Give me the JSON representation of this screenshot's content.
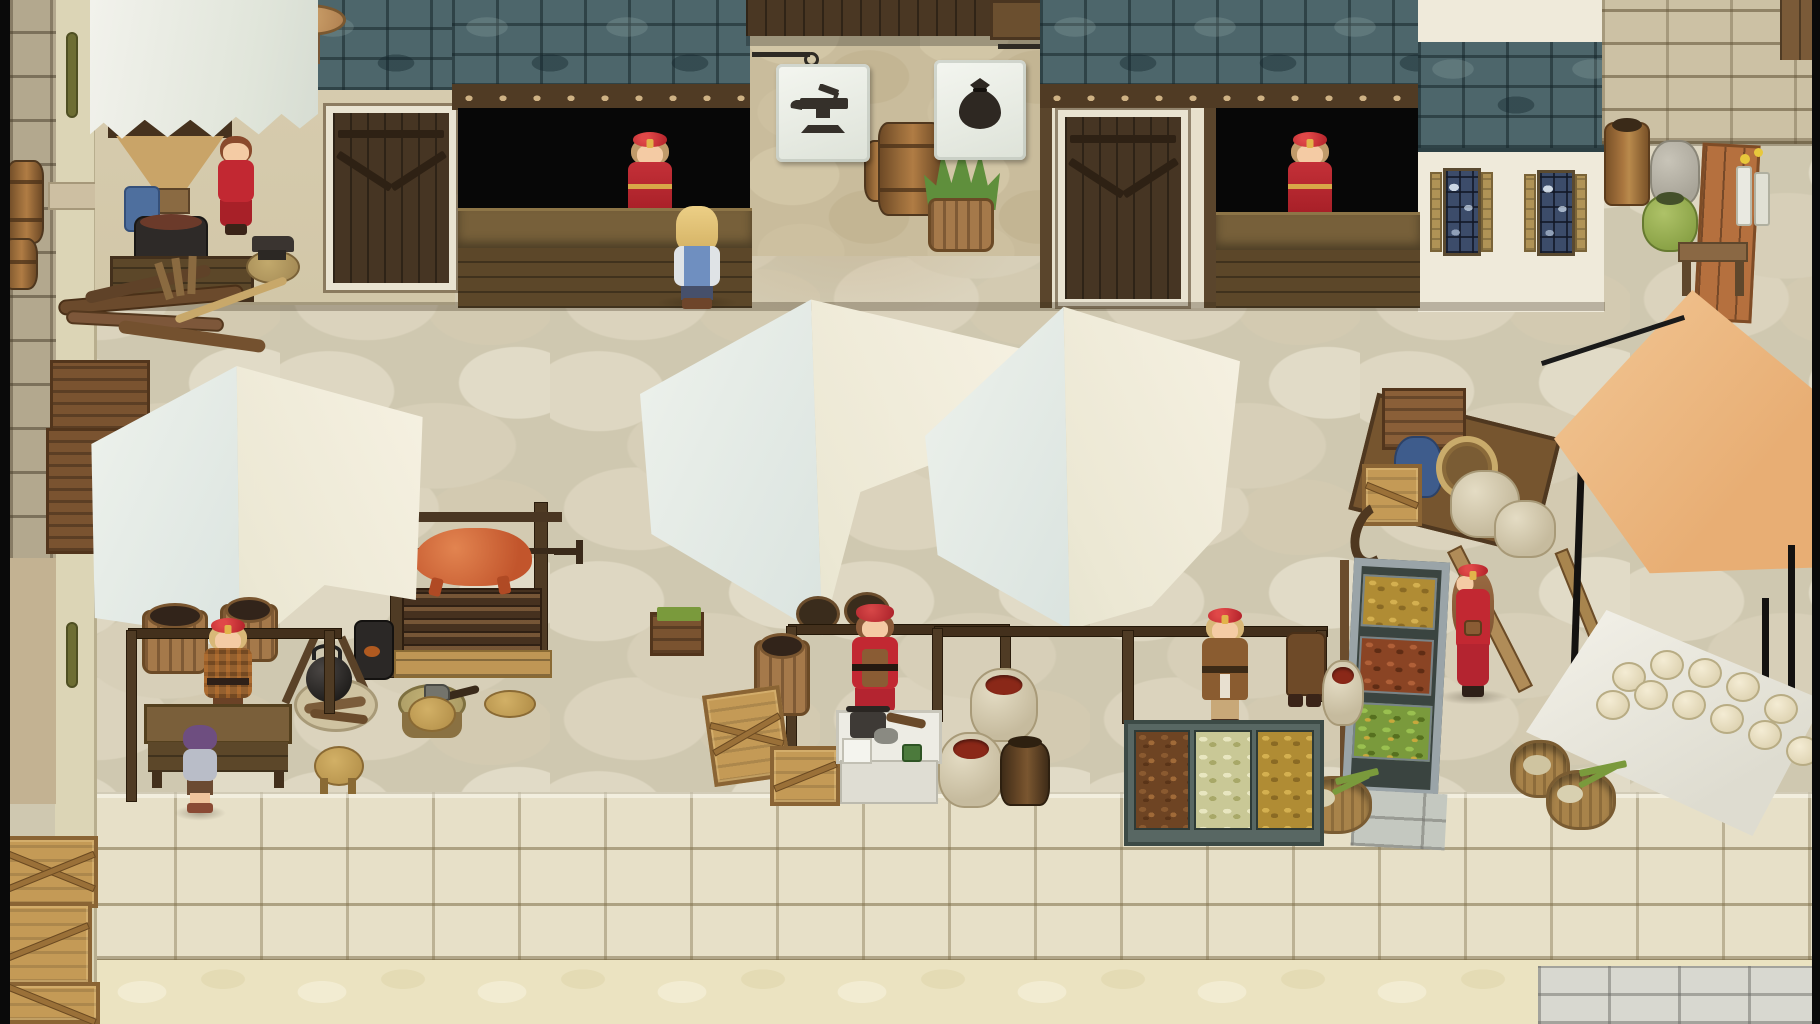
{
  "scene": {
    "title": "Hand-painted RPG market street",
    "type": "2D top-down town plaza, daytime",
    "viewport": "1820x1024"
  },
  "palette": {
    "pavement": "#cfc8b0",
    "terrace_block": "#e7e0c8",
    "roof_teal": "#4d666b",
    "wood_dark": "#4a3723",
    "wood_light": "#c49a56",
    "banner_white": "#eef0ea",
    "sign_ink": "#35302a",
    "canopy_white": "#eef2ec",
    "canopy_cream": "#f6f1e2",
    "awning_orange": "#eab47e",
    "npc_red": "#c22832",
    "skin": "#f4cba4",
    "roast_meat": "#d4693a",
    "edge_black": "#0a0a0a"
  },
  "signs": [
    {
      "id": "blacksmith-sign",
      "icon": "anvil-icon",
      "shape": "white hanging banner"
    },
    {
      "id": "trader-sign",
      "icon": "money-bag-icon",
      "shape": "white hanging banner"
    }
  ],
  "buildings": {
    "forge": {
      "label": "open-air smithy",
      "features": [
        "white scalloped awning",
        "ore hopper",
        "quench basin",
        "anvil on stump",
        "work table",
        "mushroom stool"
      ]
    },
    "shop_left": {
      "label": "counter shop window with shopkeeper",
      "sign": "anvil"
    },
    "shop_right": {
      "label": "counter shop window with shopkeeper",
      "sign": "money bag"
    },
    "doors": [
      "dark plank door west",
      "dark plank door east"
    ],
    "white_house": {
      "label": "stone cottage with teal roof",
      "windows": 2
    }
  },
  "characters": [
    {
      "id": "forge-assistant",
      "desc": "woman in red dress working at the forge",
      "x": 214,
      "y": 130
    },
    {
      "id": "shopkeeper-left",
      "desc": "shopkeeper in red beret behind west counter",
      "x": 622,
      "y": 132
    },
    {
      "id": "player",
      "desc": "blond adventurer in blue shirt facing the counter",
      "x": 666,
      "y": 204
    },
    {
      "id": "shopkeeper-right",
      "desc": "shopkeeper in red beret behind east counter",
      "x": 1282,
      "y": 132
    },
    {
      "id": "stall-vendor-west",
      "desc": "vendor in brown plaid coat and red cap",
      "x": 202,
      "y": 618
    },
    {
      "id": "child-customer",
      "desc": "purple-haired child at the stall table",
      "x": 180,
      "y": 722
    },
    {
      "id": "stall-vendor-center",
      "desc": "woman in red kerchief and apron at goods table",
      "x": 848,
      "y": 604
    },
    {
      "id": "stall-vendor-east",
      "desc": "vendor in long brown coat and red cap",
      "x": 1198,
      "y": 608
    },
    {
      "id": "stall-helper",
      "desc": "helper in brown coat behind east stall",
      "x": 1286,
      "y": 632
    },
    {
      "id": "strolling-woman",
      "desc": "woman in red dress with satchel walking left",
      "x": 1446,
      "y": 564
    }
  ],
  "stalls": [
    {
      "id": "stall-west",
      "tent": "white canopy",
      "items": [
        "wooden table",
        "basket barrels",
        "campfire with kettle",
        "stump with axe",
        "stools"
      ]
    },
    {
      "id": "stall-center",
      "tent": "white canopy",
      "items": [
        "white goods table with scale",
        "crates",
        "spice sacks",
        "clay jar",
        "wooden tub"
      ]
    },
    {
      "id": "stall-east",
      "tent": "white canopy",
      "items": [
        "triple produce bin: dried roots, pale beans, golden roots",
        "spice sacks"
      ]
    }
  ],
  "props": [
    {
      "id": "roasting-spit",
      "desc": "pig roasting over firewood with crank"
    },
    {
      "id": "produce-rack",
      "desc": "tilted rack: yellow pods, red roots, green pods"
    },
    {
      "id": "hand-cart",
      "desc": "wooden cart with crates, blue sack, basket, white sacks"
    },
    {
      "id": "orange-awning",
      "desc": "orange market awning on thin black poles"
    },
    {
      "id": "dough-table",
      "desc": "white cloth table with rounds of dough"
    },
    {
      "id": "vegetable-baskets",
      "desc": "woven baskets with green onions"
    },
    {
      "id": "barrels-and-plant",
      "desc": "barrels and potted grass by the passage"
    },
    {
      "id": "street-items",
      "desc": "urn, grey sack, green pot, leaning board, bench"
    },
    {
      "id": "firewood-logs",
      "desc": "log pile and rake"
    },
    {
      "id": "crates",
      "desc": "golden crates with cross braces"
    }
  ]
}
